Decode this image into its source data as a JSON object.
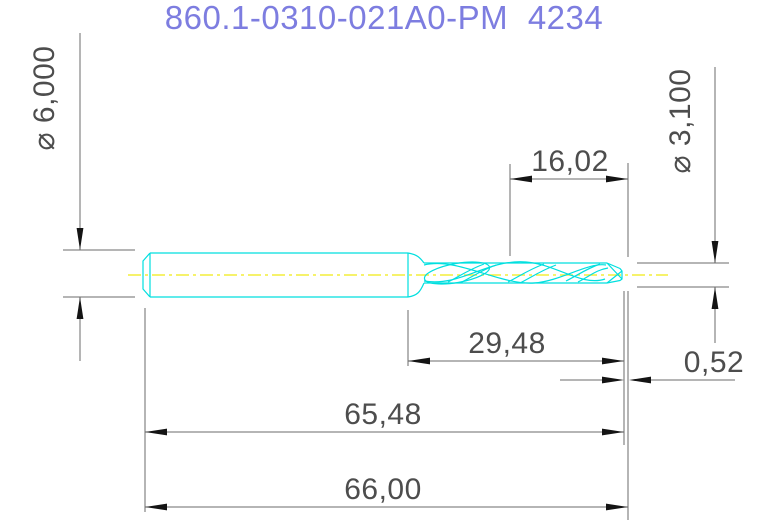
{
  "title": {
    "text": "860.1-0310-021A0-PM 4234"
  },
  "colors": {
    "title": "#7d7de0",
    "part_outline": "#00dfdf",
    "centerline": "#f4ee3a",
    "dimension_line": "#6b6b6b",
    "arrow": "#141414",
    "dimension_text": "#4d4d4d",
    "background": "#ffffff"
  },
  "part": {
    "type": "twist-drill-side-view"
  },
  "dimensions": {
    "shank_diameter": {
      "label": "⌀ 6,000",
      "orientation": "vertical-left"
    },
    "cutting_diameter": {
      "label": "⌀ 3,100",
      "orientation": "vertical-right"
    },
    "tip_segment": {
      "label": "16,02",
      "orientation": "horizontal-top"
    },
    "flute_length": {
      "label": "29,48",
      "orientation": "horizontal"
    },
    "body_length": {
      "label": "65,48",
      "orientation": "horizontal"
    },
    "overall_length": {
      "label": "66,00",
      "orientation": "horizontal"
    },
    "point_length": {
      "label": "0,52",
      "orientation": "horizontal-right"
    }
  }
}
